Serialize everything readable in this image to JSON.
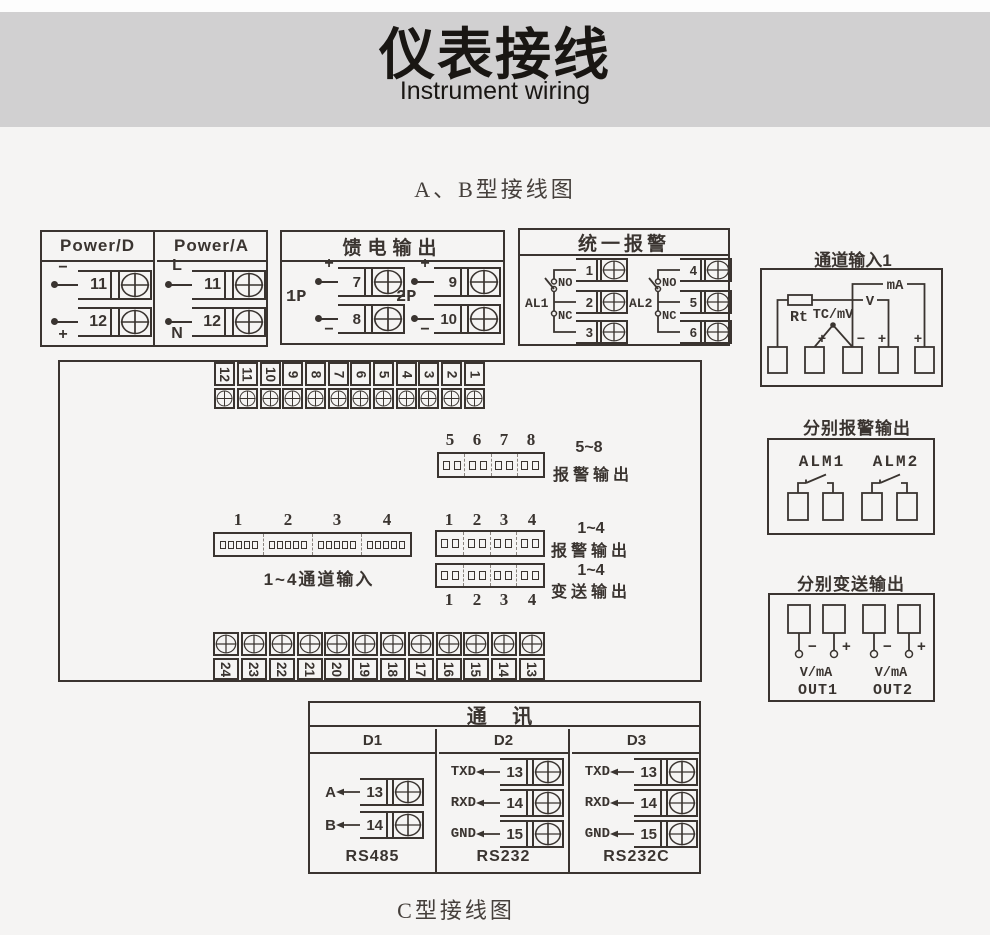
{
  "header": {
    "title_cn": "仪表接线",
    "subtitle_en": "Instrument wiring"
  },
  "section_titles": {
    "ab": "A、B型接线图",
    "c": "C型接线图"
  },
  "power_box": {
    "columns": [
      {
        "title": "Power/D",
        "terminals": [
          {
            "num": "11",
            "tag": "−"
          },
          {
            "num": "12",
            "tag": "+"
          }
        ]
      },
      {
        "title": "Power/A",
        "terminals": [
          {
            "num": "11",
            "tag": "L"
          },
          {
            "num": "12",
            "tag": "N"
          }
        ]
      }
    ]
  },
  "feed_box": {
    "title": "馈电输出",
    "groups": [
      {
        "name": "1P",
        "top": {
          "sign": "+",
          "num": "7"
        },
        "bottom": {
          "sign": "−",
          "num": "8"
        }
      },
      {
        "name": "2P",
        "top": {
          "sign": "+",
          "num": "9"
        },
        "bottom": {
          "sign": "−",
          "num": "10"
        }
      }
    ]
  },
  "alarm_box": {
    "title": "统一报警",
    "groups": [
      {
        "name": "AL1",
        "no": "NO",
        "nc": "NC",
        "t": [
          "1",
          "2",
          "3"
        ]
      },
      {
        "name": "AL2",
        "no": "NO",
        "nc": "NC",
        "t": [
          "4",
          "5",
          "6"
        ]
      }
    ]
  },
  "channel_input": {
    "title": "通道输入1",
    "rt": "Rt",
    "tc": "TC/mV",
    "v": "V",
    "ma": "mA",
    "signs": [
      "+",
      "−",
      "+",
      "+"
    ]
  },
  "main_box": {
    "top_strip": [
      "12",
      "11",
      "10",
      "9",
      "8",
      "7",
      "6",
      "5",
      "4",
      "3",
      "2",
      "1"
    ],
    "bottom_strip": [
      "24",
      "23",
      "22",
      "21",
      "20",
      "19",
      "18",
      "17",
      "16",
      "15",
      "14",
      "13"
    ],
    "alarm58": {
      "nums": [
        "5",
        "6",
        "7",
        "8"
      ],
      "cap1": "5~8",
      "cap2": "报警输出"
    },
    "ch14": {
      "nums": [
        "1",
        "2",
        "3",
        "4"
      ],
      "cap": "1~4通道输入"
    },
    "alarm14": {
      "nums": [
        "1",
        "2",
        "3",
        "4"
      ],
      "cap1": "1~4",
      "cap2": "报警输出"
    },
    "tx14": {
      "nums": [
        "1",
        "2",
        "3",
        "4"
      ],
      "cap1": "1~4",
      "cap2": "变送输出"
    }
  },
  "sep_alarm": {
    "title": "分别报警输出",
    "groups": [
      "ALM1",
      "ALM2"
    ]
  },
  "sep_tx": {
    "title": "分别变送输出",
    "vma": "V/mA",
    "signs": [
      "−",
      "+",
      "−",
      "+"
    ],
    "outs": [
      "OUT1",
      "OUT2"
    ]
  },
  "comm": {
    "title": "通 讯",
    "cols": [
      {
        "h": "D1",
        "f": "RS485",
        "rows": [
          {
            "s": "A",
            "n": "13"
          },
          {
            "s": "B",
            "n": "14"
          }
        ]
      },
      {
        "h": "D2",
        "f": "RS232",
        "rows": [
          {
            "s": "TXD",
            "n": "13"
          },
          {
            "s": "RXD",
            "n": "14"
          },
          {
            "s": "GND",
            "n": "15"
          }
        ]
      },
      {
        "h": "D3",
        "f": "RS232C",
        "rows": [
          {
            "s": "TXD",
            "n": "13"
          },
          {
            "s": "RXD",
            "n": "14"
          },
          {
            "s": "GND",
            "n": "15"
          }
        ]
      }
    ]
  },
  "colors": {
    "ink": "#3a3430",
    "band": "#d1d0d1",
    "bg": "#f5f4f3"
  }
}
